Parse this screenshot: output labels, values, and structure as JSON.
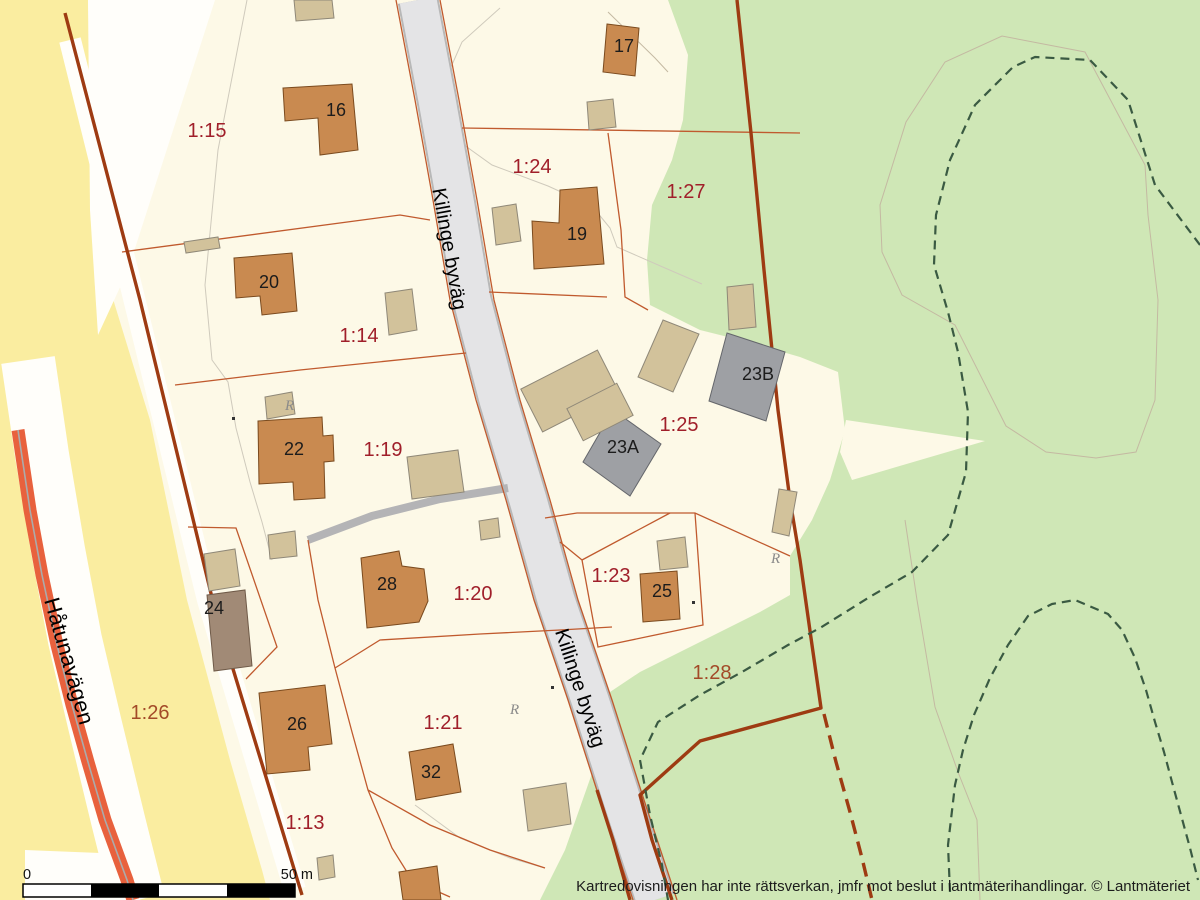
{
  "roads": {
    "killinge": {
      "name": "Killinge byväg"
    },
    "hatunavagen": {
      "name": "Håtunavägen"
    }
  },
  "parcels": [
    {
      "label": "1:15"
    },
    {
      "label": "1:24"
    },
    {
      "label": "1:27"
    },
    {
      "label": "1:14"
    },
    {
      "label": "1:19"
    },
    {
      "label": "1:25"
    },
    {
      "label": "1:23"
    },
    {
      "label": "1:20"
    },
    {
      "label": "1:21"
    },
    {
      "label": "1:26"
    },
    {
      "label": "1:28"
    },
    {
      "label": "1:13"
    }
  ],
  "buildings": [
    {
      "number": "16"
    },
    {
      "number": "17"
    },
    {
      "number": "19"
    },
    {
      "number": "20"
    },
    {
      "number": "22"
    },
    {
      "number": "23A"
    },
    {
      "number": "23B"
    },
    {
      "number": "24"
    },
    {
      "number": "25"
    },
    {
      "number": "26"
    },
    {
      "number": "28"
    },
    {
      "number": "32"
    }
  ],
  "symbols": {
    "ancient_remains": "R"
  },
  "scale_bar": {
    "start": "0",
    "end": "50 m"
  },
  "footer": {
    "disclaimer": "Kartredovisningen har inte rättsverkan, jmfr mot beslut i lantmäterihandlingar. © Lantmäteriet"
  },
  "colors": {
    "parcel_fill": "#fdf9e7",
    "field_yellow": "#faeda0",
    "forest_green": "#cfe7b6",
    "road_gray": "#e4e4e6",
    "major_road_orange": "#e8613d",
    "building_orange": "#c98a50",
    "building_tan": "#d2c29b",
    "building_gray": "#9ea0a4",
    "building_mauve": "#a18a76",
    "boundary_dark_red": "#9e3b12",
    "parcel_line_orange": "#c05a2e",
    "parcel_label_red": "#a01f2a",
    "trail_green": "#3a5a42"
  }
}
